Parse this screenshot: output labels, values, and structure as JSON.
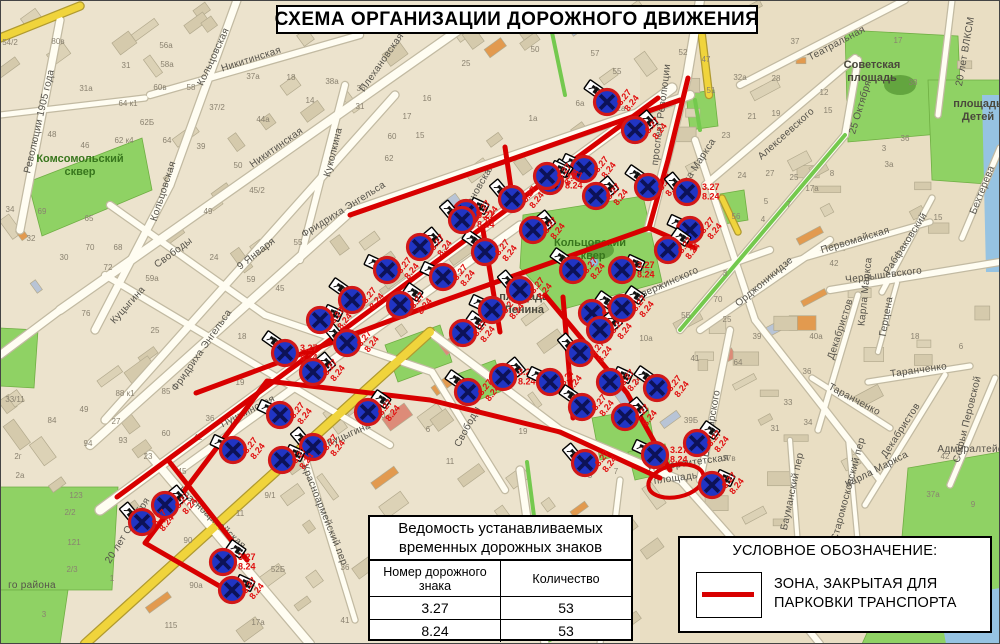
{
  "title": "СХЕМА ОРГАНИЗАЦИИ ДОРОЖНОГО ДВИЖЕНИЯ",
  "legend": {
    "heading": "УСЛОВНОЕ ОБОЗНАЧЕНИЕ:",
    "item_line1": "ЗОНА, ЗАКРЫТАЯ ДЛЯ",
    "item_line2": "ПАРКОВКИ ТРАНСПОРТА"
  },
  "table": {
    "title_line1": "Ведомость устанавливаемых",
    "title_line2": "временных дорожных знаков",
    "col1": "Номер дорожного знака",
    "col2": "Количество",
    "rows": [
      [
        "3.27",
        "53"
      ],
      [
        "8.24",
        "53"
      ]
    ]
  },
  "colors": {
    "red_zone": "#d80000",
    "sign_blue": "#2135c4",
    "sign_ring": "#d21818",
    "sign_cross": "#0d1257",
    "label_red": "#e01010",
    "park_green": "#8fd264",
    "road_yellow": "#f0d43c",
    "water_blue": "#96c3e2"
  },
  "signs": {
    "codes": [
      "3.27",
      "8.24"
    ],
    "positions": [
      [
        607,
        102
      ],
      [
        635,
        130
      ],
      [
        584,
        169
      ],
      [
        550,
        181
      ],
      [
        512,
        199
      ],
      [
        466,
        213
      ],
      [
        648,
        187
      ],
      [
        596,
        196
      ],
      [
        690,
        230
      ],
      [
        668,
        250
      ],
      [
        687,
        192
      ],
      [
        547,
        176
      ],
      [
        485,
        252
      ],
      [
        533,
        230
      ],
      [
        443,
        277
      ],
      [
        463,
        333
      ],
      [
        520,
        290
      ],
      [
        622,
        270
      ],
      [
        573,
        270
      ],
      [
        420,
        247
      ],
      [
        387,
        270
      ],
      [
        400,
        305
      ],
      [
        347,
        343
      ],
      [
        320,
        320
      ],
      [
        285,
        353
      ],
      [
        313,
        372
      ],
      [
        280,
        415
      ],
      [
        368,
        412
      ],
      [
        313,
        447
      ],
      [
        282,
        460
      ],
      [
        468,
        392
      ],
      [
        503,
        377
      ],
      [
        550,
        382
      ],
      [
        592,
        313
      ],
      [
        580,
        353
      ],
      [
        610,
        382
      ],
      [
        582,
        407
      ],
      [
        625,
        417
      ],
      [
        655,
        455
      ],
      [
        697,
        443
      ],
      [
        585,
        463
      ],
      [
        712,
        485
      ],
      [
        657,
        388
      ],
      [
        165,
        505
      ],
      [
        233,
        450
      ],
      [
        223,
        562
      ],
      [
        142,
        522
      ],
      [
        232,
        590
      ],
      [
        352,
        300
      ],
      [
        600,
        330
      ],
      [
        492,
        310
      ],
      [
        622,
        308
      ],
      [
        462,
        220
      ]
    ]
  },
  "red_zone": {
    "lines": [
      [
        [
          117,
          497
        ],
        [
          658,
          98
        ]
      ],
      [
        [
          688,
          78
        ],
        [
          668,
          160
        ],
        [
          649,
          228
        ]
      ],
      [
        [
          680,
          100
        ],
        [
          515,
          158
        ],
        [
          350,
          215
        ]
      ],
      [
        [
          649,
          228
        ],
        [
          440,
          302
        ],
        [
          250,
          373
        ],
        [
          196,
          393
        ]
      ],
      [
        [
          235,
          595
        ],
        [
          145,
          543
        ],
        [
          267,
          381
        ],
        [
          430,
          400
        ],
        [
          560,
          432
        ],
        [
          660,
          478
        ]
      ],
      [
        [
          168,
          460
        ],
        [
          247,
          560
        ]
      ],
      [
        [
          545,
          295
        ],
        [
          627,
          393
        ],
        [
          670,
          470
        ]
      ],
      [
        [
          483,
          230
        ],
        [
          500,
          332
        ]
      ],
      [
        [
          563,
          297
        ],
        [
          573,
          418
        ]
      ],
      [
        [
          505,
          147
        ],
        [
          513,
          202
        ]
      ],
      [
        [
          649,
          228
        ],
        [
          695,
          248
        ]
      ]
    ],
    "circle": {
      "cx": 676,
      "cy": 481,
      "rx": 28,
      "ry": 16,
      "rot": -12
    }
  },
  "street_labels": [
    [
      "Революции 1905 года",
      42,
      122,
      -77
    ],
    [
      "Кольцовская",
      216,
      58,
      -65
    ],
    [
      "Кольцовская",
      166,
      192,
      -72
    ],
    [
      "Никитинская",
      252,
      62,
      -18
    ],
    [
      "Никитинская",
      278,
      150,
      -35
    ],
    [
      "Плехановская",
      384,
      64,
      -55
    ],
    [
      "Плехановская",
      477,
      196,
      -60
    ],
    [
      "Куколкина",
      336,
      153,
      -76
    ],
    [
      "Фридриха Энгельса",
      345,
      212,
      -32
    ],
    [
      "Фридриха Энгельса",
      204,
      352,
      -55
    ],
    [
      "Свободы",
      175,
      255,
      -36
    ],
    [
      "Свободы",
      470,
      428,
      -62
    ],
    [
      "9 Января",
      258,
      256,
      -38
    ],
    [
      "Куцыгина",
      130,
      307,
      -48
    ],
    [
      "Куцыгина",
      350,
      437,
      -24
    ],
    [
      "Пушкинская",
      249,
      414,
      -27
    ],
    [
      "20 лет Октября",
      130,
      532,
      -58
    ],
    [
      "Красноармейская",
      210,
      520,
      42
    ],
    [
      "Красноармейский пер",
      322,
      516,
      68
    ],
    [
      "проспект Революции",
      664,
      115,
      -83
    ],
    [
      "Карла Маркса",
      697,
      170,
      -57
    ],
    [
      "Карла Маркса",
      868,
      292,
      -84
    ],
    [
      "Карла Маркса",
      878,
      472,
      -27
    ],
    [
      "Театральная",
      838,
      46,
      -28
    ],
    [
      "25 Октября",
      863,
      108,
      -73
    ],
    [
      "20 лет ВЛКСМ",
      968,
      52,
      -80
    ],
    [
      "Алексеевского",
      788,
      136,
      -42
    ],
    [
      "Первомайская",
      856,
      243,
      -17
    ],
    [
      "Рабфаковский",
      908,
      245,
      -57
    ],
    [
      "Бехтерева",
      985,
      191,
      -68
    ],
    [
      "Дзержинского",
      668,
      286,
      -24
    ],
    [
      "Орджоникидзе",
      766,
      284,
      -40
    ],
    [
      "Чернышевского",
      884,
      278,
      -7
    ],
    [
      "Декабристов",
      843,
      330,
      -72
    ],
    [
      "Декабристов",
      903,
      432,
      -57
    ],
    [
      "Герцена",
      889,
      317,
      -80
    ],
    [
      "Таранченко",
      919,
      373,
      -8
    ],
    [
      "Таранченко",
      853,
      402,
      28
    ],
    [
      "Софьи Перовской",
      970,
      420,
      -76
    ],
    [
      "Володарского",
      714,
      424,
      -80
    ],
    [
      "Университетская",
      688,
      466,
      -8
    ],
    [
      "площадь",
      676,
      481,
      -8
    ],
    [
      "Старомосковский пер",
      851,
      490,
      -75
    ],
    [
      "Бауманский пер",
      795,
      492,
      -78
    ],
    [
      "Адмиралтейская площадь",
      1002,
      452,
      0
    ],
    [
      "го района",
      32,
      588,
      0
    ]
  ],
  "area_labels": [
    {
      "lines": [
        "Комсомольский",
        "сквер"
      ],
      "x": 80,
      "y": 162,
      "kind": "park"
    },
    {
      "lines": [
        "Кольцовский",
        "сквер"
      ],
      "x": 590,
      "y": 246,
      "kind": "park"
    },
    {
      "lines": [
        "Советская",
        "площадь"
      ],
      "x": 872,
      "y": 68,
      "kind": "square"
    },
    {
      "lines": [
        "площадь",
        "Детей"
      ],
      "x": 978,
      "y": 107,
      "kind": "square"
    },
    {
      "lines": [
        "площадь",
        "Ленина"
      ],
      "x": 524,
      "y": 300,
      "kind": "square"
    }
  ],
  "house_numbers": [
    [
      "54/2",
      10,
      45
    ],
    [
      "80в",
      58,
      44
    ],
    [
      "31",
      126,
      68
    ],
    [
      "31а",
      86,
      91
    ],
    [
      "56а",
      166,
      48
    ],
    [
      "58а",
      167,
      67
    ],
    [
      "60в",
      160,
      90
    ],
    [
      "58",
      191,
      90
    ],
    [
      "64 к1",
      128,
      106
    ],
    [
      "62Б",
      147,
      125
    ],
    [
      "62 к4",
      124,
      143
    ],
    [
      "64",
      167,
      143
    ],
    [
      "48",
      52,
      137
    ],
    [
      "46",
      85,
      148
    ],
    [
      "34",
      10,
      212
    ],
    [
      "69",
      42,
      214
    ],
    [
      "65",
      89,
      221
    ],
    [
      "32",
      31,
      241
    ],
    [
      "70",
      90,
      250
    ],
    [
      "68",
      118,
      250
    ],
    [
      "30",
      64,
      260
    ],
    [
      "72",
      108,
      270
    ],
    [
      "59а",
      152,
      281
    ],
    [
      "37/2",
      217,
      110
    ],
    [
      "37а",
      253,
      79
    ],
    [
      "18",
      291,
      80
    ],
    [
      "38а",
      332,
      84
    ],
    [
      "36",
      361,
      91
    ],
    [
      "14",
      310,
      103
    ],
    [
      "31",
      360,
      109
    ],
    [
      "16",
      427,
      101
    ],
    [
      "17",
      407,
      119
    ],
    [
      "15",
      420,
      138
    ],
    [
      "60",
      392,
      139
    ],
    [
      "62",
      389,
      161
    ],
    [
      "44а",
      263,
      122
    ],
    [
      "39",
      201,
      149
    ],
    [
      "50",
      238,
      168
    ],
    [
      "45/2",
      257,
      193
    ],
    [
      "49",
      208,
      214
    ],
    [
      "50",
      535,
      52
    ],
    [
      "57",
      595,
      56
    ],
    [
      "25",
      466,
      66
    ],
    [
      "55",
      617,
      74
    ],
    [
      "6а",
      580,
      106
    ],
    [
      "1а",
      533,
      121
    ],
    [
      "2а",
      621,
      111
    ],
    [
      "52",
      683,
      55
    ],
    [
      "47",
      706,
      62
    ],
    [
      "32а",
      740,
      80
    ],
    [
      "28",
      776,
      81
    ],
    [
      "51",
      711,
      93
    ],
    [
      "21",
      752,
      119
    ],
    [
      "19",
      776,
      116
    ],
    [
      "23",
      726,
      138
    ],
    [
      "12",
      824,
      95
    ],
    [
      "15",
      828,
      113
    ],
    [
      "17",
      898,
      43
    ],
    [
      "38",
      913,
      85
    ],
    [
      "36",
      905,
      141
    ],
    [
      "27",
      770,
      176
    ],
    [
      "25",
      794,
      180
    ],
    [
      "24",
      742,
      178
    ],
    [
      "5",
      766,
      204
    ],
    [
      "7",
      789,
      207
    ],
    [
      "56",
      736,
      219
    ],
    [
      "42",
      834,
      266
    ],
    [
      "3",
      725,
      276
    ],
    [
      "70",
      718,
      302
    ],
    [
      "5Б",
      686,
      318
    ],
    [
      "10а",
      646,
      341
    ],
    [
      "25",
      727,
      322
    ],
    [
      "39",
      757,
      339
    ],
    [
      "40а",
      816,
      339
    ],
    [
      "18",
      915,
      339
    ],
    [
      "41",
      695,
      361
    ],
    [
      "64",
      738,
      365
    ],
    [
      "36",
      807,
      374
    ],
    [
      "33",
      788,
      405
    ],
    [
      "34",
      808,
      425
    ],
    [
      "31",
      775,
      431
    ],
    [
      "39Б",
      691,
      423
    ],
    [
      "37в",
      729,
      461
    ],
    [
      "42",
      945,
      459
    ],
    [
      "37а",
      933,
      497
    ],
    [
      "9",
      973,
      507
    ],
    [
      "10Б",
      645,
      273
    ],
    [
      "33/11",
      15,
      402
    ],
    [
      "84",
      52,
      423
    ],
    [
      "49",
      84,
      412
    ],
    [
      "27",
      116,
      424
    ],
    [
      "94",
      88,
      446
    ],
    [
      "93",
      123,
      443
    ],
    [
      "23",
      148,
      459
    ],
    [
      "88 к1",
      125,
      396
    ],
    [
      "85",
      166,
      394
    ],
    [
      "60",
      166,
      436
    ],
    [
      "42",
      198,
      440
    ],
    [
      "36",
      210,
      421
    ],
    [
      "19",
      240,
      385
    ],
    [
      "45",
      182,
      474
    ],
    [
      "123",
      76,
      498
    ],
    [
      "2/2",
      70,
      515
    ],
    [
      "121",
      74,
      545
    ],
    [
      "2/3",
      72,
      572
    ],
    [
      "1",
      112,
      581
    ],
    [
      "115",
      171,
      628
    ],
    [
      "90",
      188,
      543
    ],
    [
      "90а",
      196,
      588
    ],
    [
      "11",
      240,
      516
    ],
    [
      "9/1",
      270,
      498
    ],
    [
      "19 к2",
      232,
      600
    ],
    [
      "17а",
      258,
      625
    ],
    [
      "52Б",
      278,
      572
    ],
    [
      "36",
      345,
      570
    ],
    [
      "41",
      345,
      623
    ],
    [
      "24",
      214,
      260
    ],
    [
      "55",
      298,
      245
    ],
    [
      "59",
      251,
      282
    ],
    [
      "45",
      280,
      291
    ],
    [
      "18",
      242,
      339
    ],
    [
      "20",
      285,
      363
    ],
    [
      "76",
      86,
      316
    ],
    [
      "25",
      155,
      333
    ],
    [
      "10",
      381,
      418
    ],
    [
      "6",
      428,
      432
    ],
    [
      "11",
      450,
      464
    ],
    [
      "19",
      523,
      434
    ],
    [
      "8",
      637,
      385
    ],
    [
      "7",
      616,
      474
    ],
    [
      "5",
      590,
      478
    ],
    [
      "6",
      961,
      349
    ],
    [
      "15",
      938,
      220
    ],
    [
      "17а",
      812,
      191
    ],
    [
      "4",
      763,
      222
    ],
    [
      "8",
      832,
      176
    ],
    [
      "3а",
      889,
      167
    ],
    [
      "3",
      884,
      151
    ],
    [
      "37",
      795,
      44
    ],
    [
      "2г",
      18,
      459
    ],
    [
      "2а",
      20,
      478
    ],
    [
      "3",
      44,
      617
    ]
  ]
}
